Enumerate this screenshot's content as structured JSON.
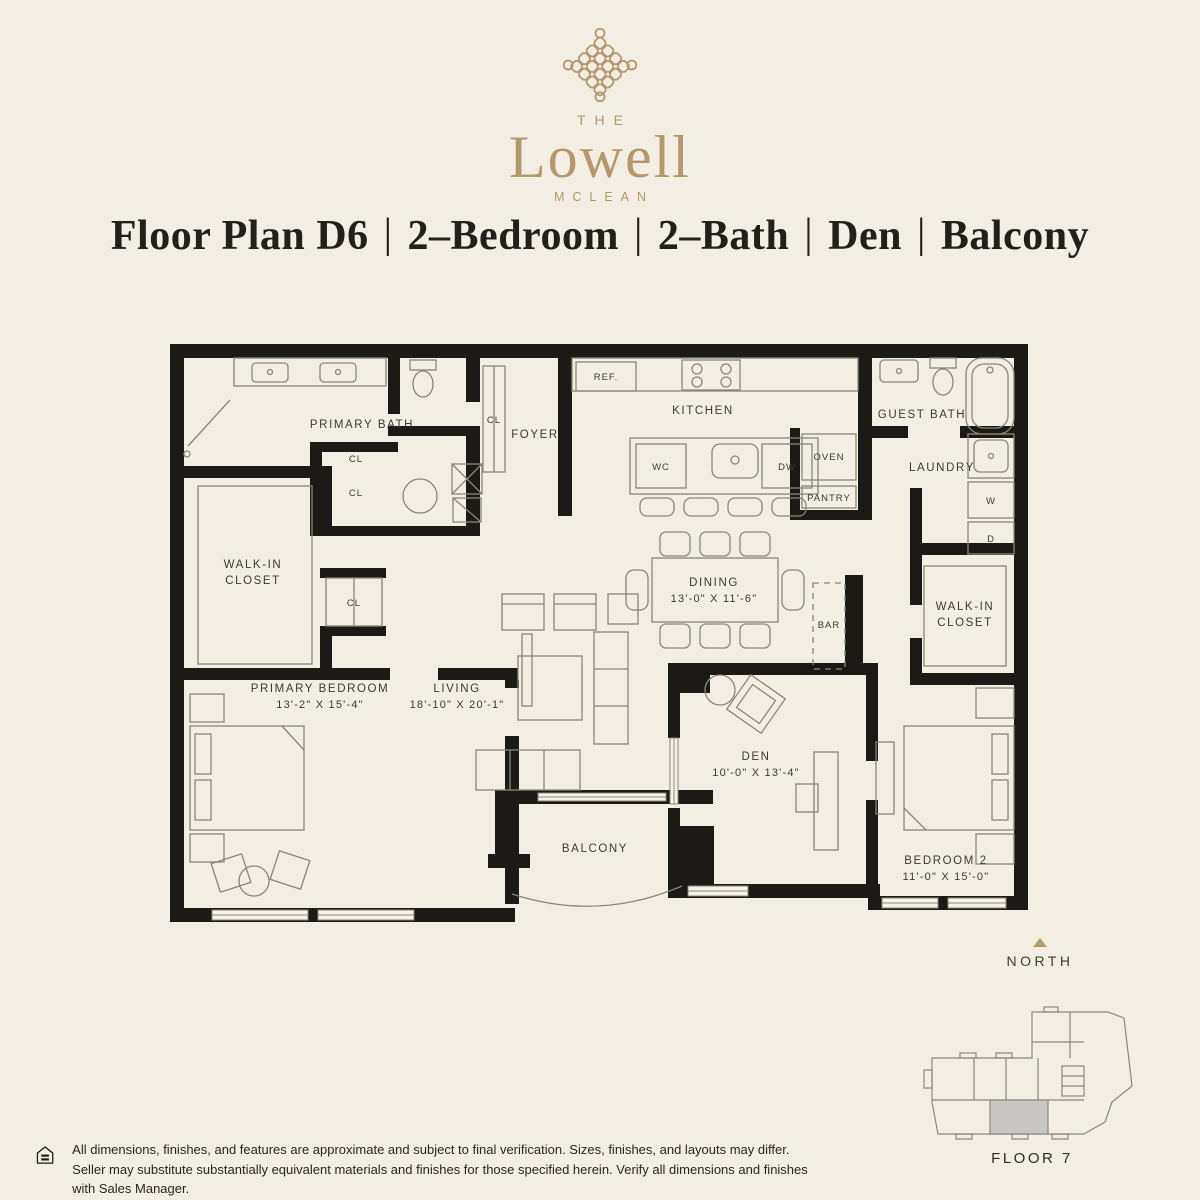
{
  "colors": {
    "background": "#f3eee3",
    "gold": "#b3986b",
    "ink": "#21201b",
    "wall": "#1b1a16",
    "furniture_line": "#8b8679",
    "keyplan_highlight": "#c7c6c2"
  },
  "brand": {
    "pre": "THE",
    "name": "Lowell",
    "sub": "MCLEAN"
  },
  "title": {
    "parts": [
      "Floor Plan D6",
      "2–Bedroom",
      "2–Bath",
      "Den",
      "Balcony"
    ],
    "separator": "|"
  },
  "plan": {
    "rooms": {
      "primary_bath": {
        "label": "PRIMARY BATH"
      },
      "foyer": {
        "label": "FOYER"
      },
      "kitchen": {
        "label": "KITCHEN"
      },
      "guest_bath": {
        "label": "GUEST BATH"
      },
      "laundry": {
        "label": "LAUNDRY"
      },
      "walk_in_closet_left": {
        "line1": "WALK-IN",
        "line2": "CLOSET"
      },
      "walk_in_closet_right": {
        "line1": "WALK-IN",
        "line2": "CLOSET"
      },
      "primary_bedroom": {
        "label": "PRIMARY BEDROOM",
        "dims": "13'-2\" X 15'-4\""
      },
      "living": {
        "label": "LIVING",
        "dims": "18'-10\" X 20'-1\""
      },
      "dining": {
        "label": "DINING",
        "dims": "13'-0\" X 11'-6\""
      },
      "den": {
        "label": "DEN",
        "dims": "10'-0\" X 13'-4\""
      },
      "bedroom_2": {
        "label": "BEDROOM 2",
        "dims": "11'-0\" X 15'-0\""
      },
      "balcony": {
        "label": "BALCONY"
      },
      "bar": {
        "label": "BAR"
      }
    },
    "fixtures": {
      "ref": "REF.",
      "wine_cooler": "WC",
      "dishwasher": "DW",
      "oven": "OVEN",
      "pantry": "PANTRY",
      "washer": "W",
      "dryer": "D",
      "closet": "CL"
    }
  },
  "compass": {
    "label": "NORTH"
  },
  "keyplan": {
    "label": "FLOOR 7"
  },
  "disclaimer": {
    "text": "All dimensions, finishes, and features are approximate and subject to final verification. Sizes, finishes, and layouts may differ. Seller may substitute substantially equivalent materials and finishes for those specified herein. Verify all dimensions and finishes with Sales Manager."
  }
}
